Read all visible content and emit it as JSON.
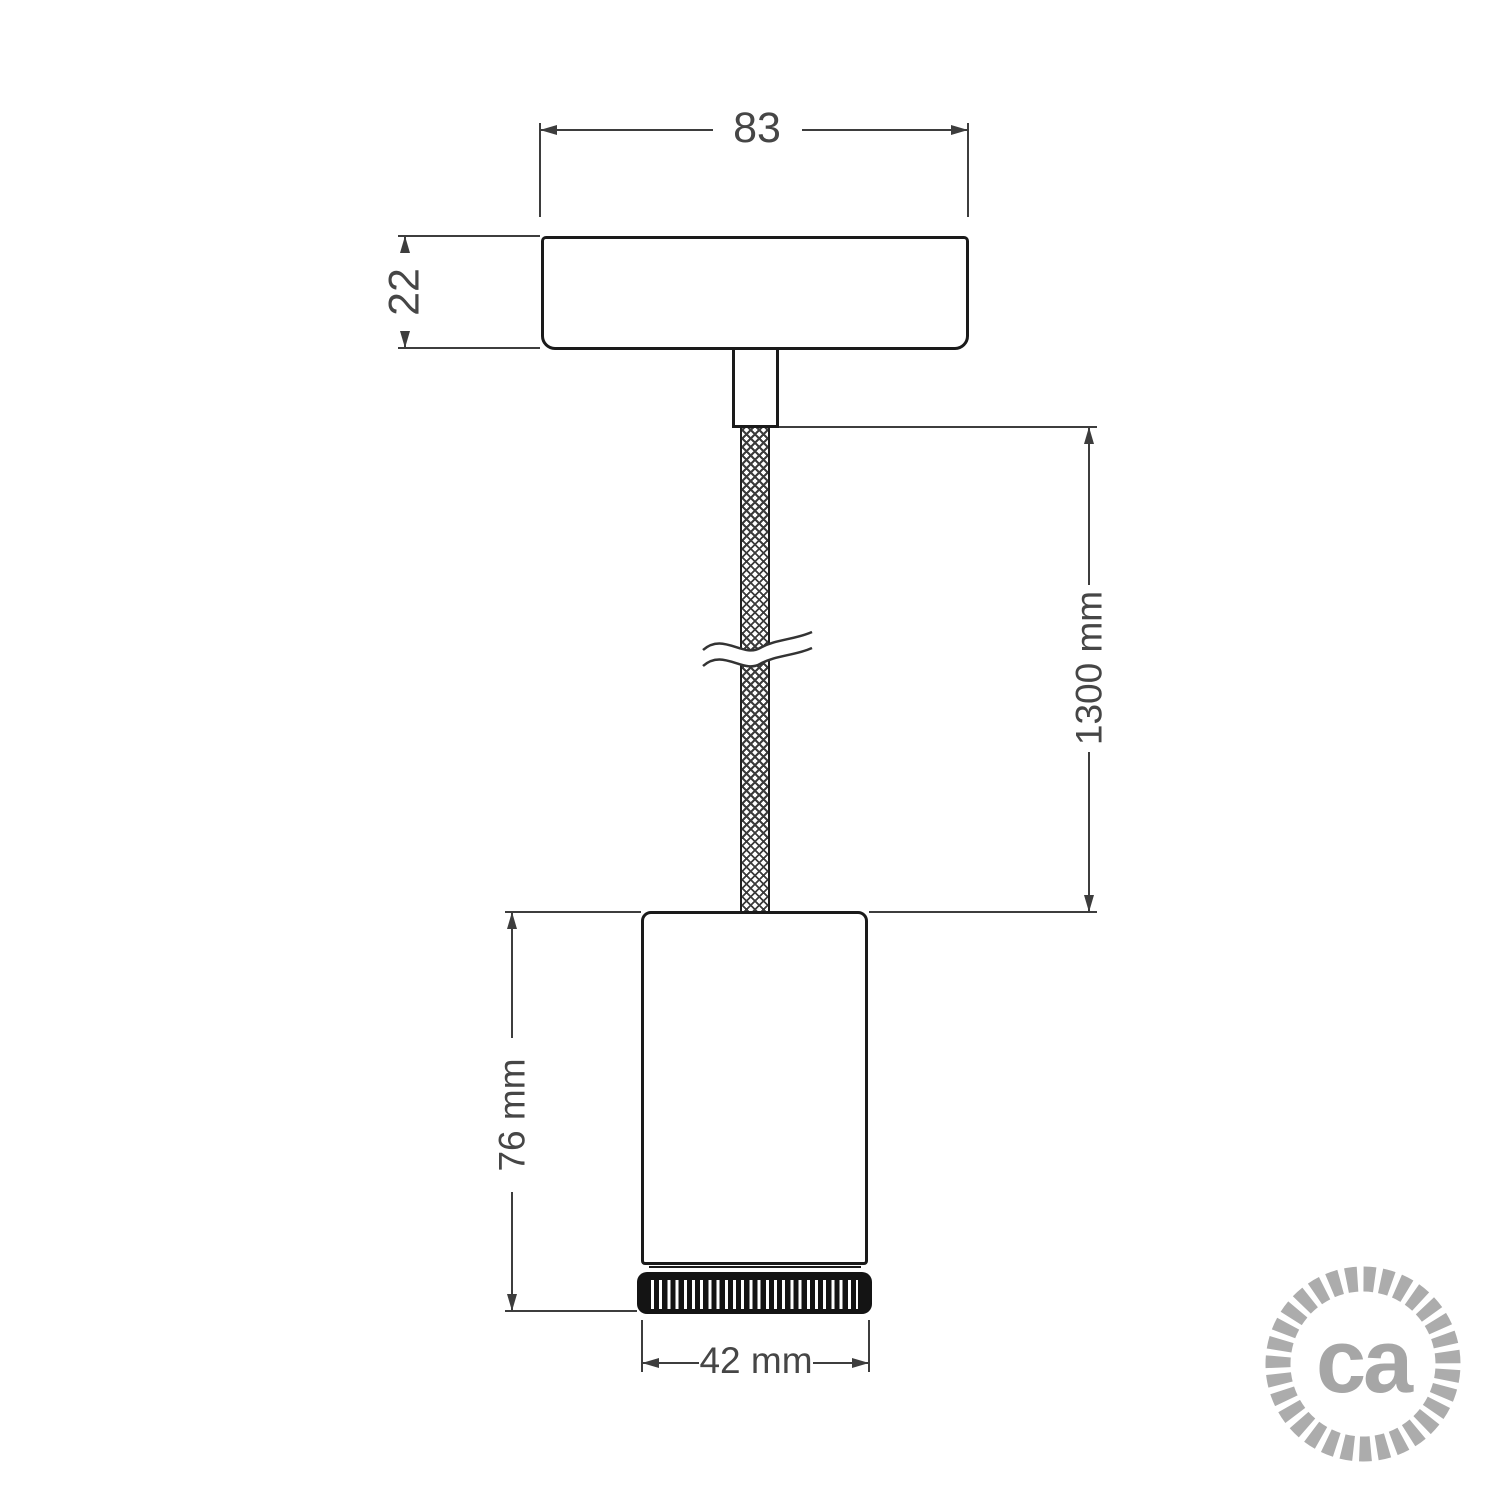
{
  "drawing": {
    "type": "pendant-lamp-dimension-drawing",
    "dimensions": {
      "canopy_width": "83",
      "canopy_height": "22",
      "cable_length": "1300 mm",
      "spot_height": "76 mm",
      "spot_diameter": "42 mm"
    },
    "parts": [
      "ceiling-canopy",
      "cable-grip-stem",
      "braided-cable",
      "cable-break-symbol",
      "spotlight-body",
      "knurled-ring"
    ]
  },
  "logo": {
    "text": "ca"
  },
  "colors": {
    "background": "#ffffff",
    "drawing_line": "#1a1a1a",
    "dimension_line": "#3d3d3d",
    "dimension_text": "#464646",
    "ring_black": "#141414",
    "logo_gray": "#a9a9a9"
  }
}
